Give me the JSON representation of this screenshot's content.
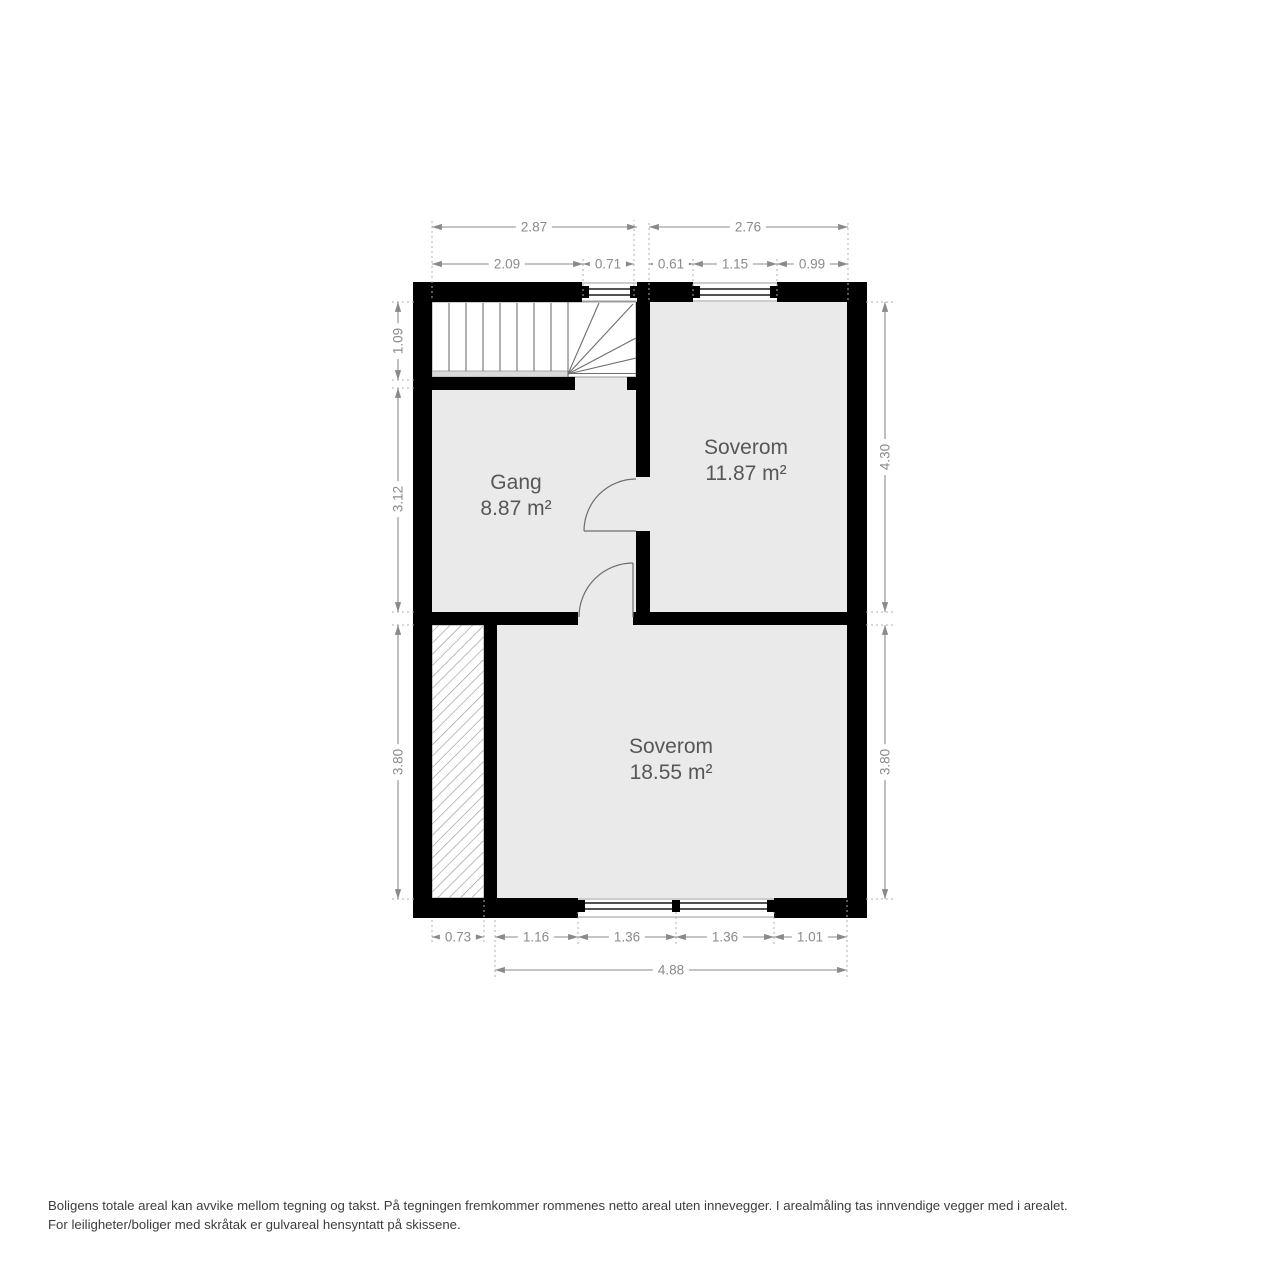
{
  "title": "Floor plan",
  "rooms": [
    {
      "name": "Gang",
      "area": "8.87 m²"
    },
    {
      "name": "Soverom",
      "area": "11.87 m²"
    },
    {
      "name": "Soverom",
      "area": "18.55 m²"
    }
  ],
  "dimensions": {
    "top_overall": [
      "2.87",
      "2.76"
    ],
    "top_segments": [
      "2.09",
      "0.71",
      "0.61",
      "1.15",
      "0.99"
    ],
    "left": [
      "1.09",
      "3.12",
      "3.80"
    ],
    "right": [
      "4.30",
      "3.80"
    ],
    "bottom_segments": [
      "0.73",
      "1.16",
      "1.36",
      "1.36",
      "1.01"
    ],
    "bottom_overall": "4.88"
  },
  "footer": {
    "line1": "Boligens totale areal kan avvike mellom tegning og takst. På tegningen fremkommer rommenes netto areal uten innevegger. I arealmåling tas innvendige vegger med i arealet.",
    "line2": "For leiligheter/boliger med skråtak er gulvareal hensyntatt på skissene."
  },
  "colors": {
    "wall": "#000000",
    "room_fill": "#eaeaea",
    "plan_line": "#6e6e6e",
    "dimension": "#8a8a8a",
    "room_text": "#575757",
    "footer_text": "#3d3d3d"
  }
}
